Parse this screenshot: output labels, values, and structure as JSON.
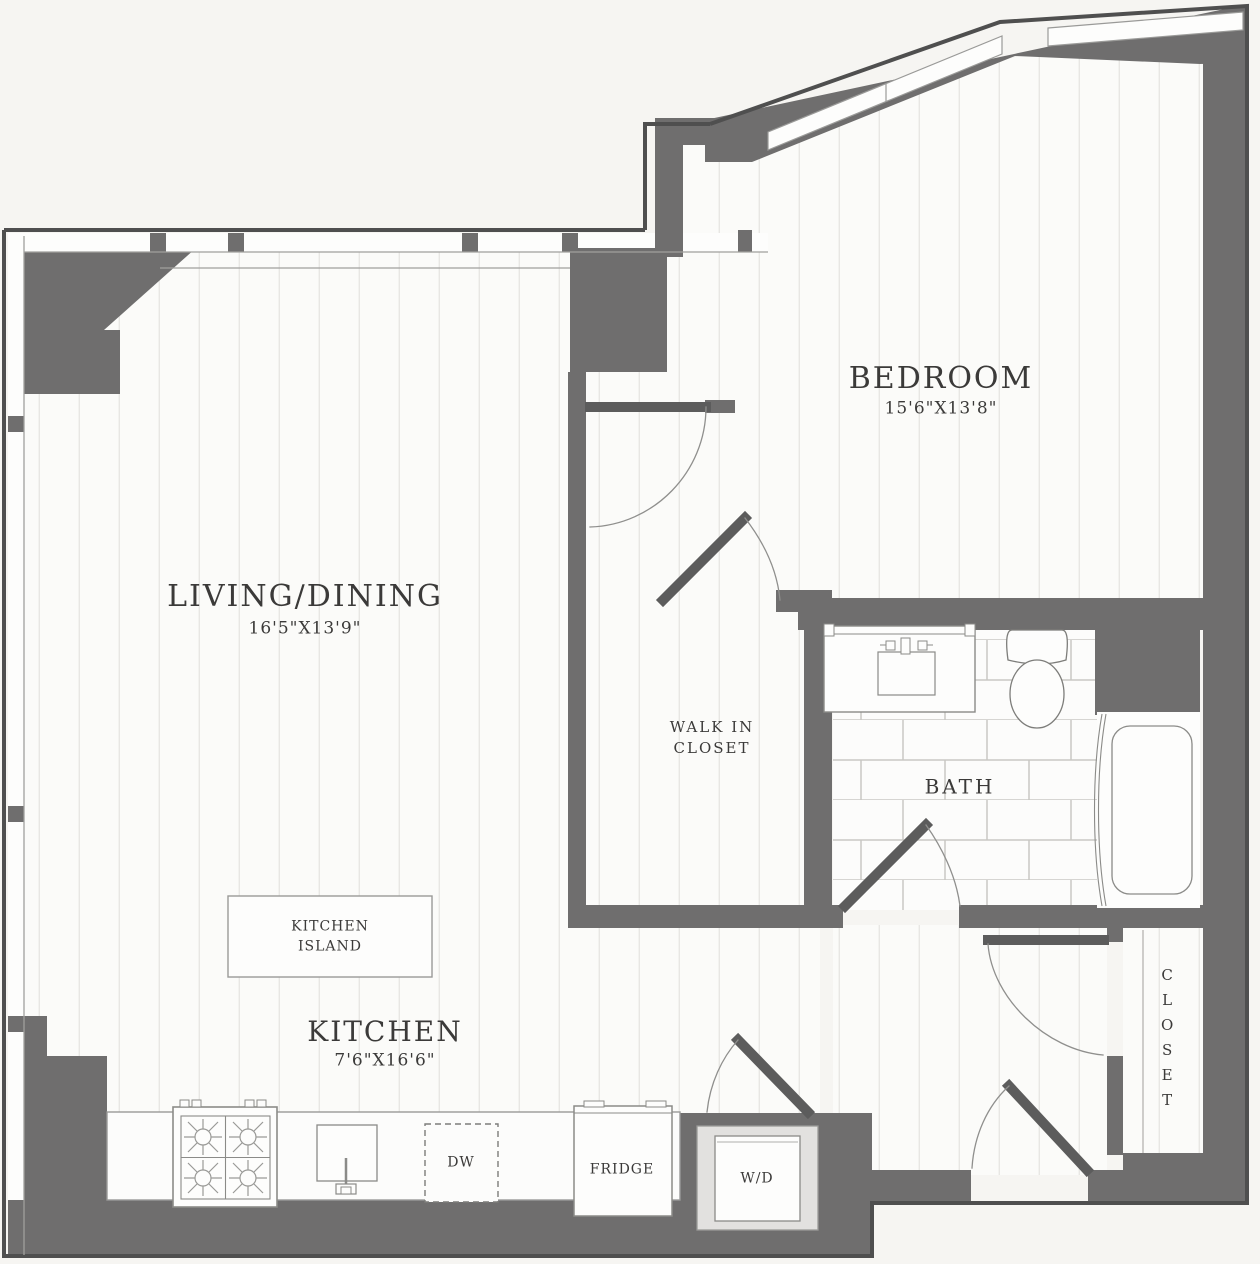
{
  "plan": {
    "title": "One-bedroom apartment floor plan",
    "rooms": {
      "living_dining": {
        "name": "LIVING/DINING",
        "dims": "16'5\"X13'9\""
      },
      "bedroom": {
        "name": "BEDROOM",
        "dims": "15'6\"X13'8\""
      },
      "kitchen": {
        "name": "KITCHEN",
        "dims": "7'6\"X16'6\""
      },
      "walk_in_closet": {
        "line1": "WALK IN",
        "line2": "CLOSET"
      },
      "bath": {
        "name": "BATH"
      },
      "closet": {
        "name": "CLOSET"
      },
      "kitchen_island": {
        "line1": "KITCHEN",
        "line2": "ISLAND"
      }
    },
    "appliances": {
      "dishwasher": "DW",
      "fridge": "FRIDGE",
      "washer_dryer": "W/D"
    },
    "colors": {
      "wall": "#6f6e6e",
      "outline": "#4f4f4f",
      "floor": "#fbfbf9",
      "background": "#f6f5f2",
      "floor_stripe": "#e8e7e4",
      "tile_line": "#c9c8c4",
      "door_leaf": "#5c5c5c",
      "text": "#3b3a39"
    }
  }
}
